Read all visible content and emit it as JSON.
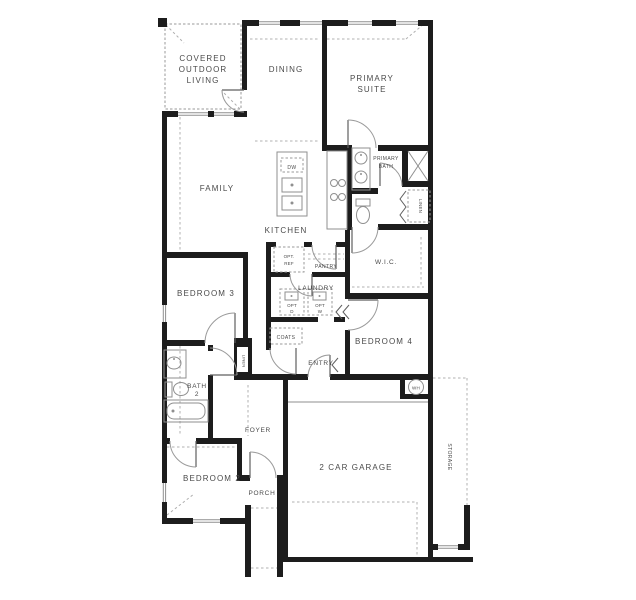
{
  "colors": {
    "wall": "#1d1d1d",
    "fixture_line": "#8f8f8f",
    "dashed_line": "#b0b0b0",
    "text": "#4a4a4a",
    "background": "#ffffff"
  },
  "labels": {
    "covered_outdoor_living": [
      "COVERED",
      "OUTDOOR",
      "LIVING"
    ],
    "dining": "DINING",
    "primary_suite": [
      "PRIMARY",
      "SUITE"
    ],
    "family": "FAMILY",
    "kitchen": "KITCHEN",
    "dishwasher": "DW",
    "primary_bath": [
      "PRIMARY",
      "BATH"
    ],
    "linen_primary": "LINEN",
    "wic": "W.I.C.",
    "opt_ref": [
      "OPT.",
      "REF"
    ],
    "pantry": "PANTRY",
    "laundry": "LAUNDRY",
    "opt_dryer": [
      "OPT",
      "D"
    ],
    "opt_washer": [
      "OPT",
      "W"
    ],
    "bedroom3": "BEDROOM 3",
    "coats": "COATS",
    "bedroom4": "BEDROOM 4",
    "entry": "ENTRY",
    "linen_hall": "LINEN",
    "bath2": [
      "BATH",
      "2"
    ],
    "foyer": "FOYER",
    "bedroom2": "BEDROOM 2",
    "porch": "PORCH",
    "garage": "2 CAR GARAGE",
    "water_heater": "WH",
    "storage": "STORAGE"
  }
}
